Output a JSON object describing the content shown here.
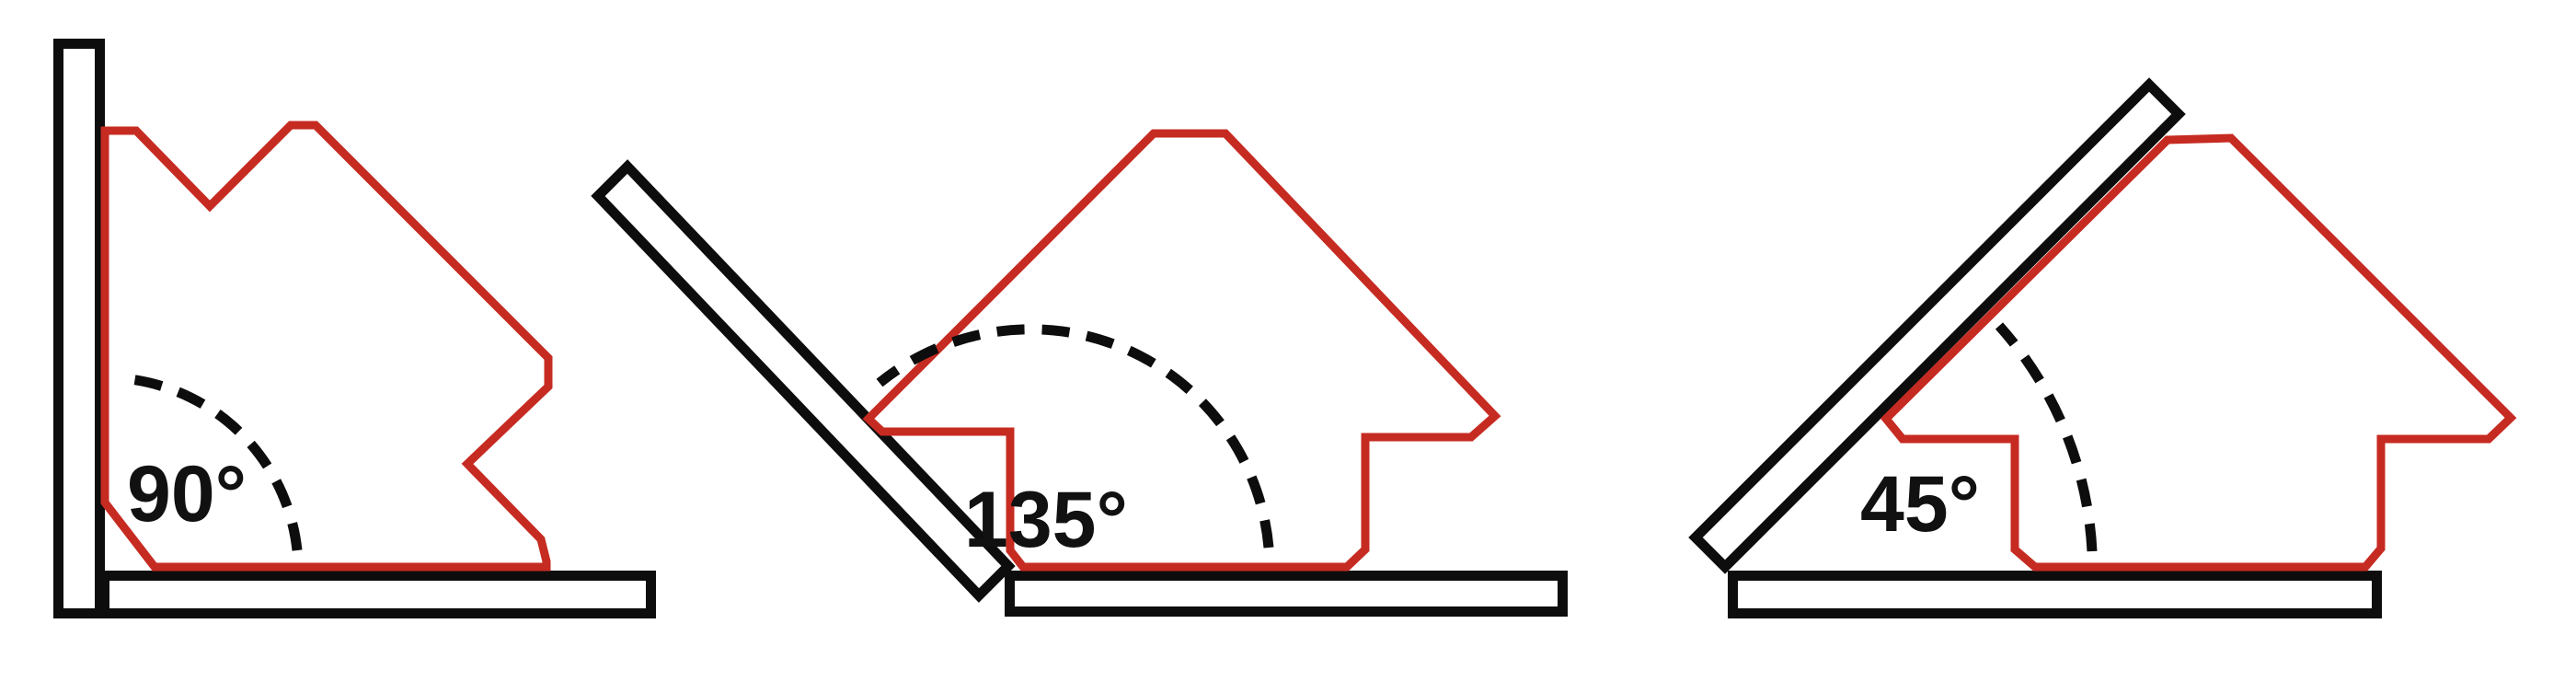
{
  "colors": {
    "magnet_red": "#c62b22",
    "steel_outline": "#0d0d0d",
    "label": "#111111",
    "background": "#ffffff"
  },
  "panels": [
    {
      "angle_label": "90°"
    },
    {
      "angle_label": "135°"
    },
    {
      "angle_label": "45°"
    }
  ]
}
